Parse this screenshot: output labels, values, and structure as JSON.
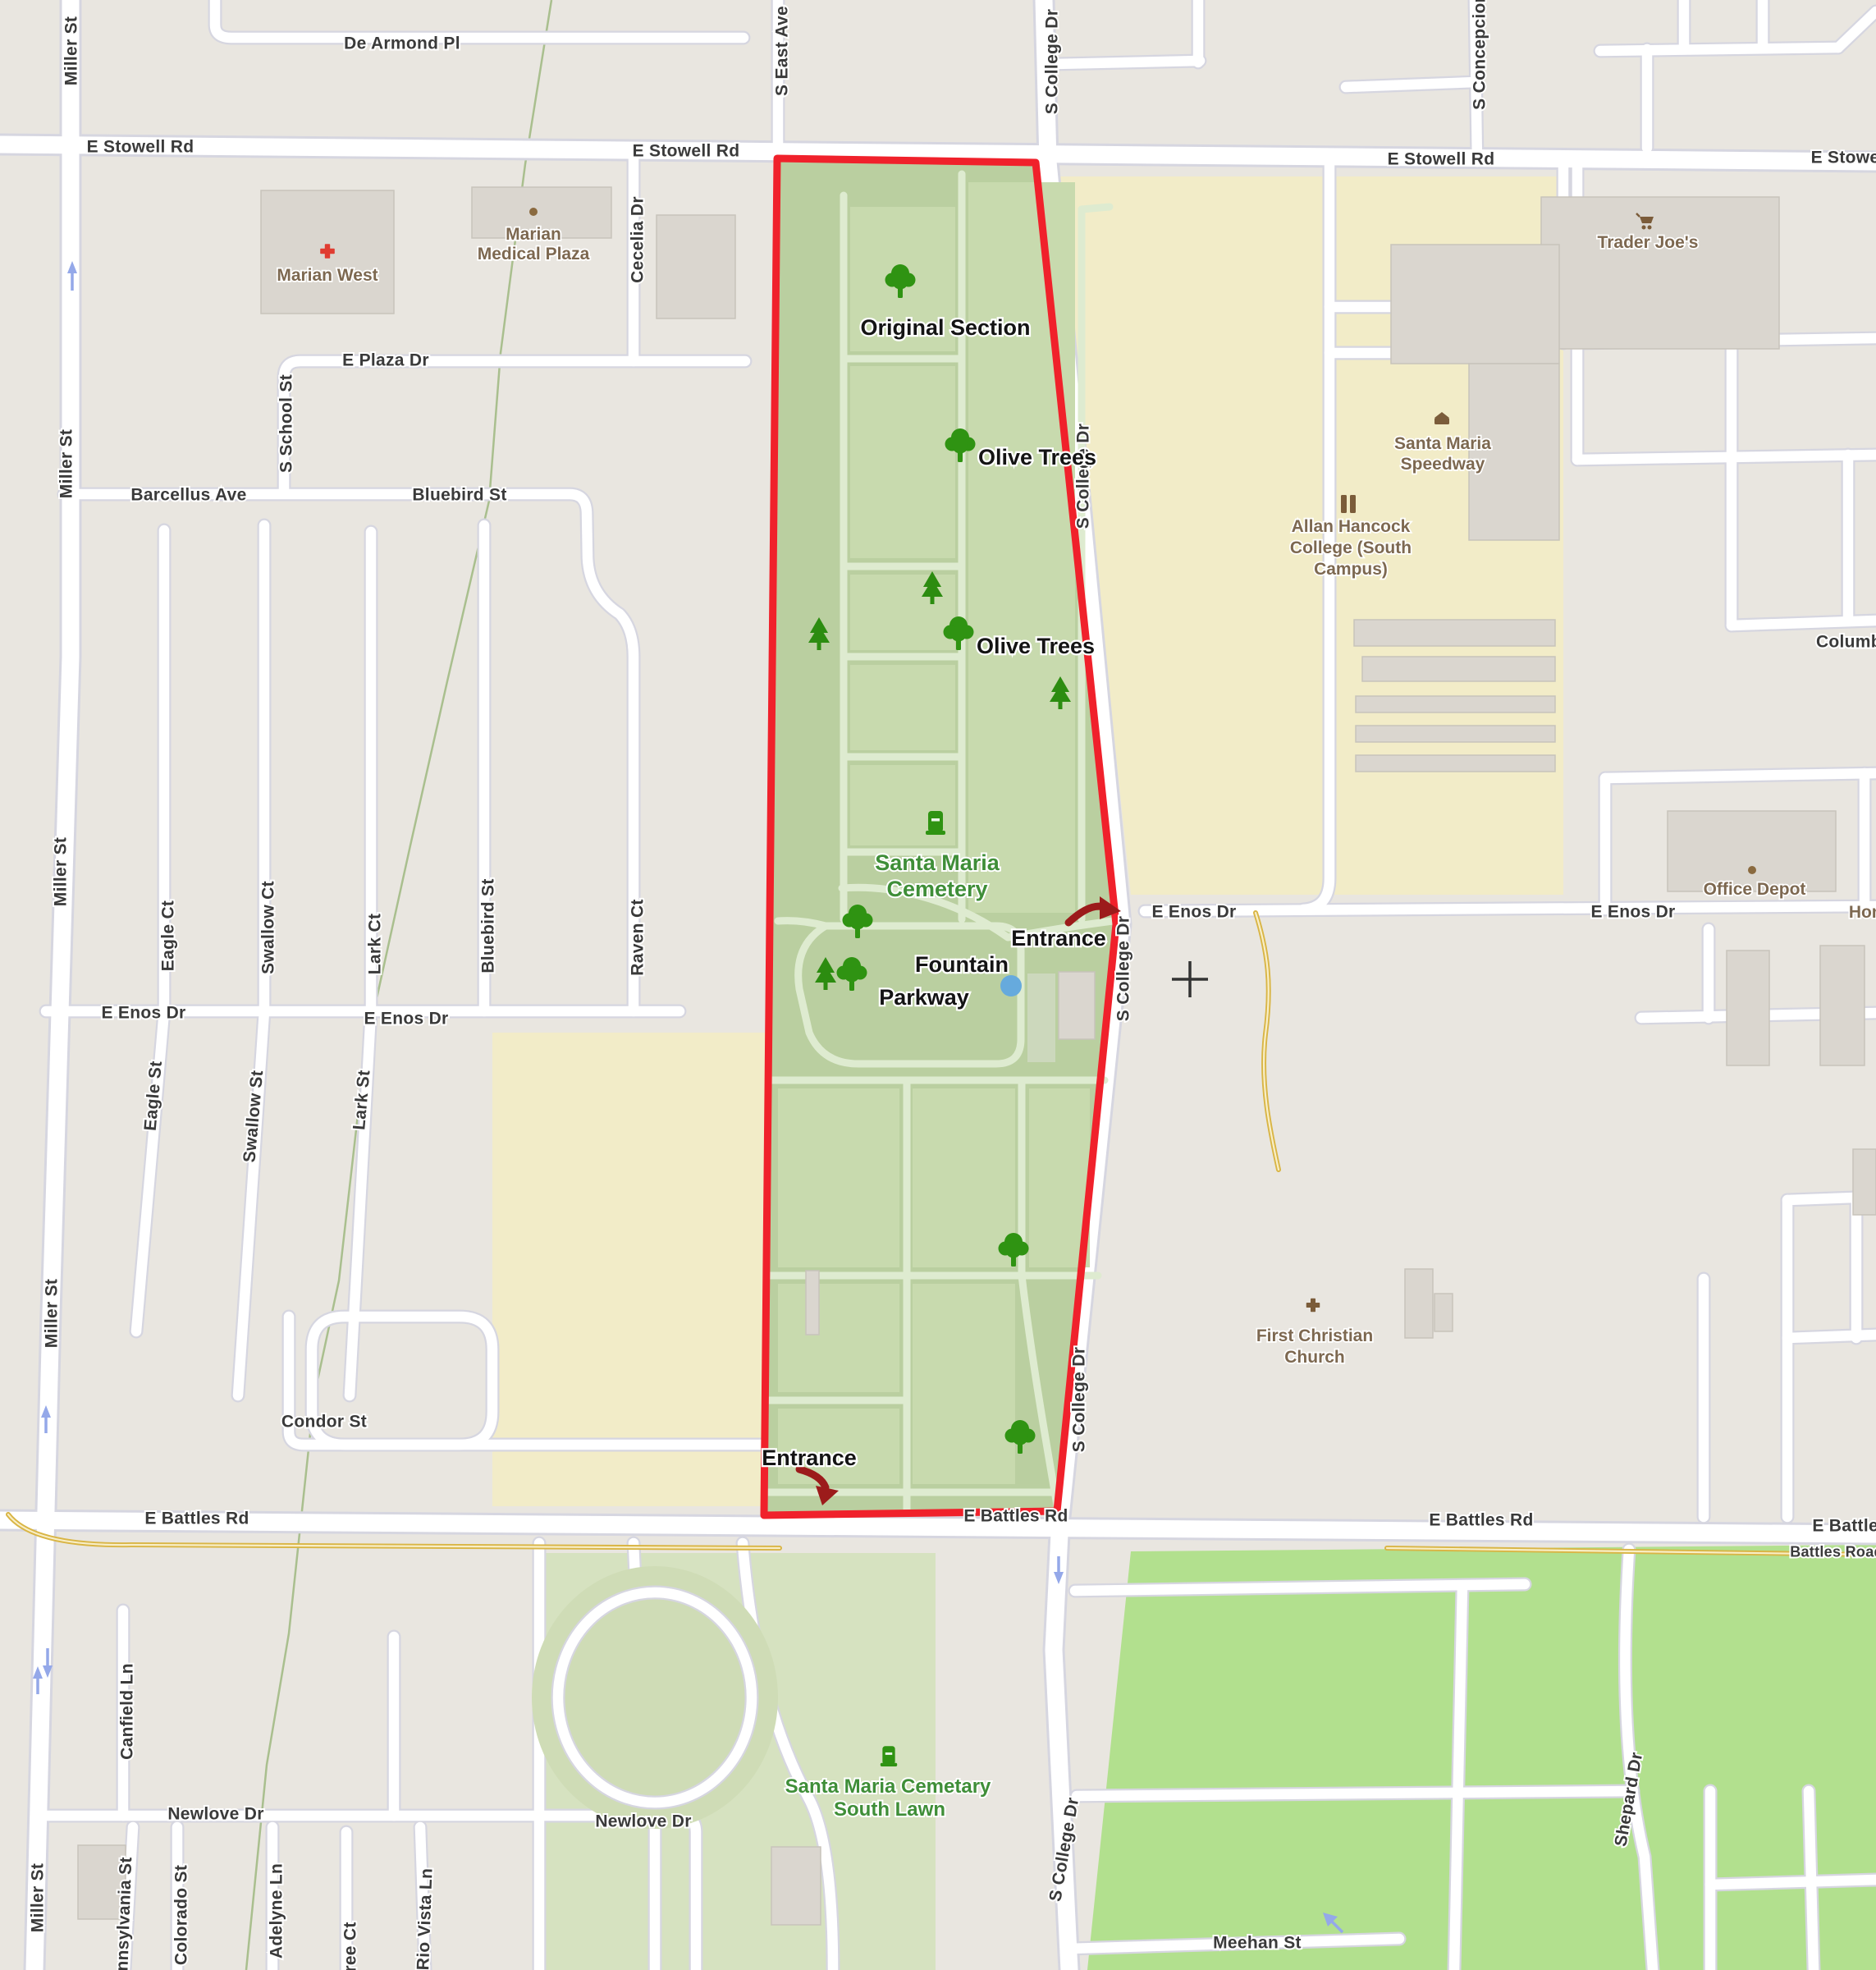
{
  "colors": {
    "bg": "#e9e6e0",
    "casing": "#d6d6e0",
    "road": "#ffffff",
    "beige": "#f2ecc8",
    "cem": "#bacfa0",
    "sec": "#c8daae",
    "cpath": "#deebd0",
    "slawn": "#d6e2c0",
    "bgreen": "#b2e08e",
    "bld": "#dad6cf",
    "bldline": "#c8c4bb",
    "boundary": "#f0212b",
    "tree": "#2f9312",
    "conifer": "#2c8c10",
    "cemtext": "#3f8e38",
    "poi": "#7d6850",
    "streettext": "#3a3a3a",
    "yroad": "#d9b545",
    "ycenter": "#f8eec6",
    "creek": "#9db77f",
    "fountain": "#66aadd",
    "redarrow": "#9c1b1b",
    "oneway": "#94a8e9",
    "crossred": "#e03c31"
  },
  "street_labels": [
    "Miller St",
    "Miller St",
    "Miller St",
    "Miller St",
    "Miller St",
    "De Armond Pl",
    "E Stowell Rd",
    "E Stowell Rd",
    "E Stowell Rd",
    "E Stowell Rd",
    "S East Ave",
    "S College Dr",
    "S College Dr",
    "S College Dr",
    "S College Dr",
    "S College Dr",
    "S Concepcion",
    "Cecelia Dr",
    "E Plaza Dr",
    "S School St",
    "Barcellus Ave",
    "Bluebird St",
    "Eagle Ct",
    "Swallow Ct",
    "Lark Ct",
    "Bluebird St",
    "Raven Ct",
    "E Enos Dr",
    "E Enos Dr",
    "E Enos Dr",
    "E Enos Dr",
    "Eagle St",
    "Swallow St",
    "Lark St",
    "Condor St",
    "E Battles Rd",
    "E Battles Rd",
    "E Battles Rd",
    "E Battles Rd",
    "Battles Road",
    "Canfield Ln",
    "Los Pinos Ct",
    "Newlove Dr",
    "Newlove Dr",
    "Pennsylvania St",
    "Colorado St",
    "Adelyne Ln",
    "ree Ct",
    "Rio Vista Ln",
    "Meehan St",
    "Shepard Dr",
    "Columbia"
  ],
  "poi_labels": [
    "Marian West",
    "Marian",
    "Medical Plaza",
    "Trader Joe's",
    "Santa Maria",
    "Speedway",
    "Allan Hancock",
    "College (South",
    "Campus)",
    "Office Depot",
    "First Christian",
    "Church",
    "Home"
  ],
  "cemetery": {
    "name_line1": "Santa Maria",
    "name_line2": "Cemetery",
    "south_line1": "Santa Maria Cemetary",
    "south_line2": "South Lawn",
    "annotations": [
      "Original Section",
      "Olive Trees",
      "Olive Trees",
      "Entrance",
      "Fountain",
      "Parkway",
      "Entrance"
    ]
  }
}
